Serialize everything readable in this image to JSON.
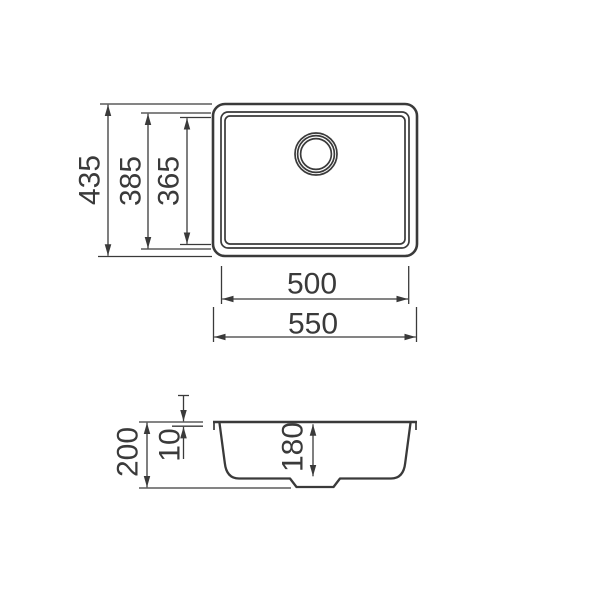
{
  "drawing": {
    "type": "technical-dimension-drawing",
    "subject": "undermount kitchen sink, top view and section view",
    "line_color": "#3a3a3a",
    "background_color": "#ffffff",
    "unit": "mm",
    "top_view": {
      "overall_height_mm": "435",
      "outer_bowl_height_mm": "385",
      "inner_bowl_height_mm": "365",
      "inner_bowl_width_mm": "500",
      "overall_width_mm": "550"
    },
    "section_view": {
      "overall_depth_mm": "200",
      "rim_thickness_mm": "10",
      "bowl_depth_mm": "180"
    }
  }
}
